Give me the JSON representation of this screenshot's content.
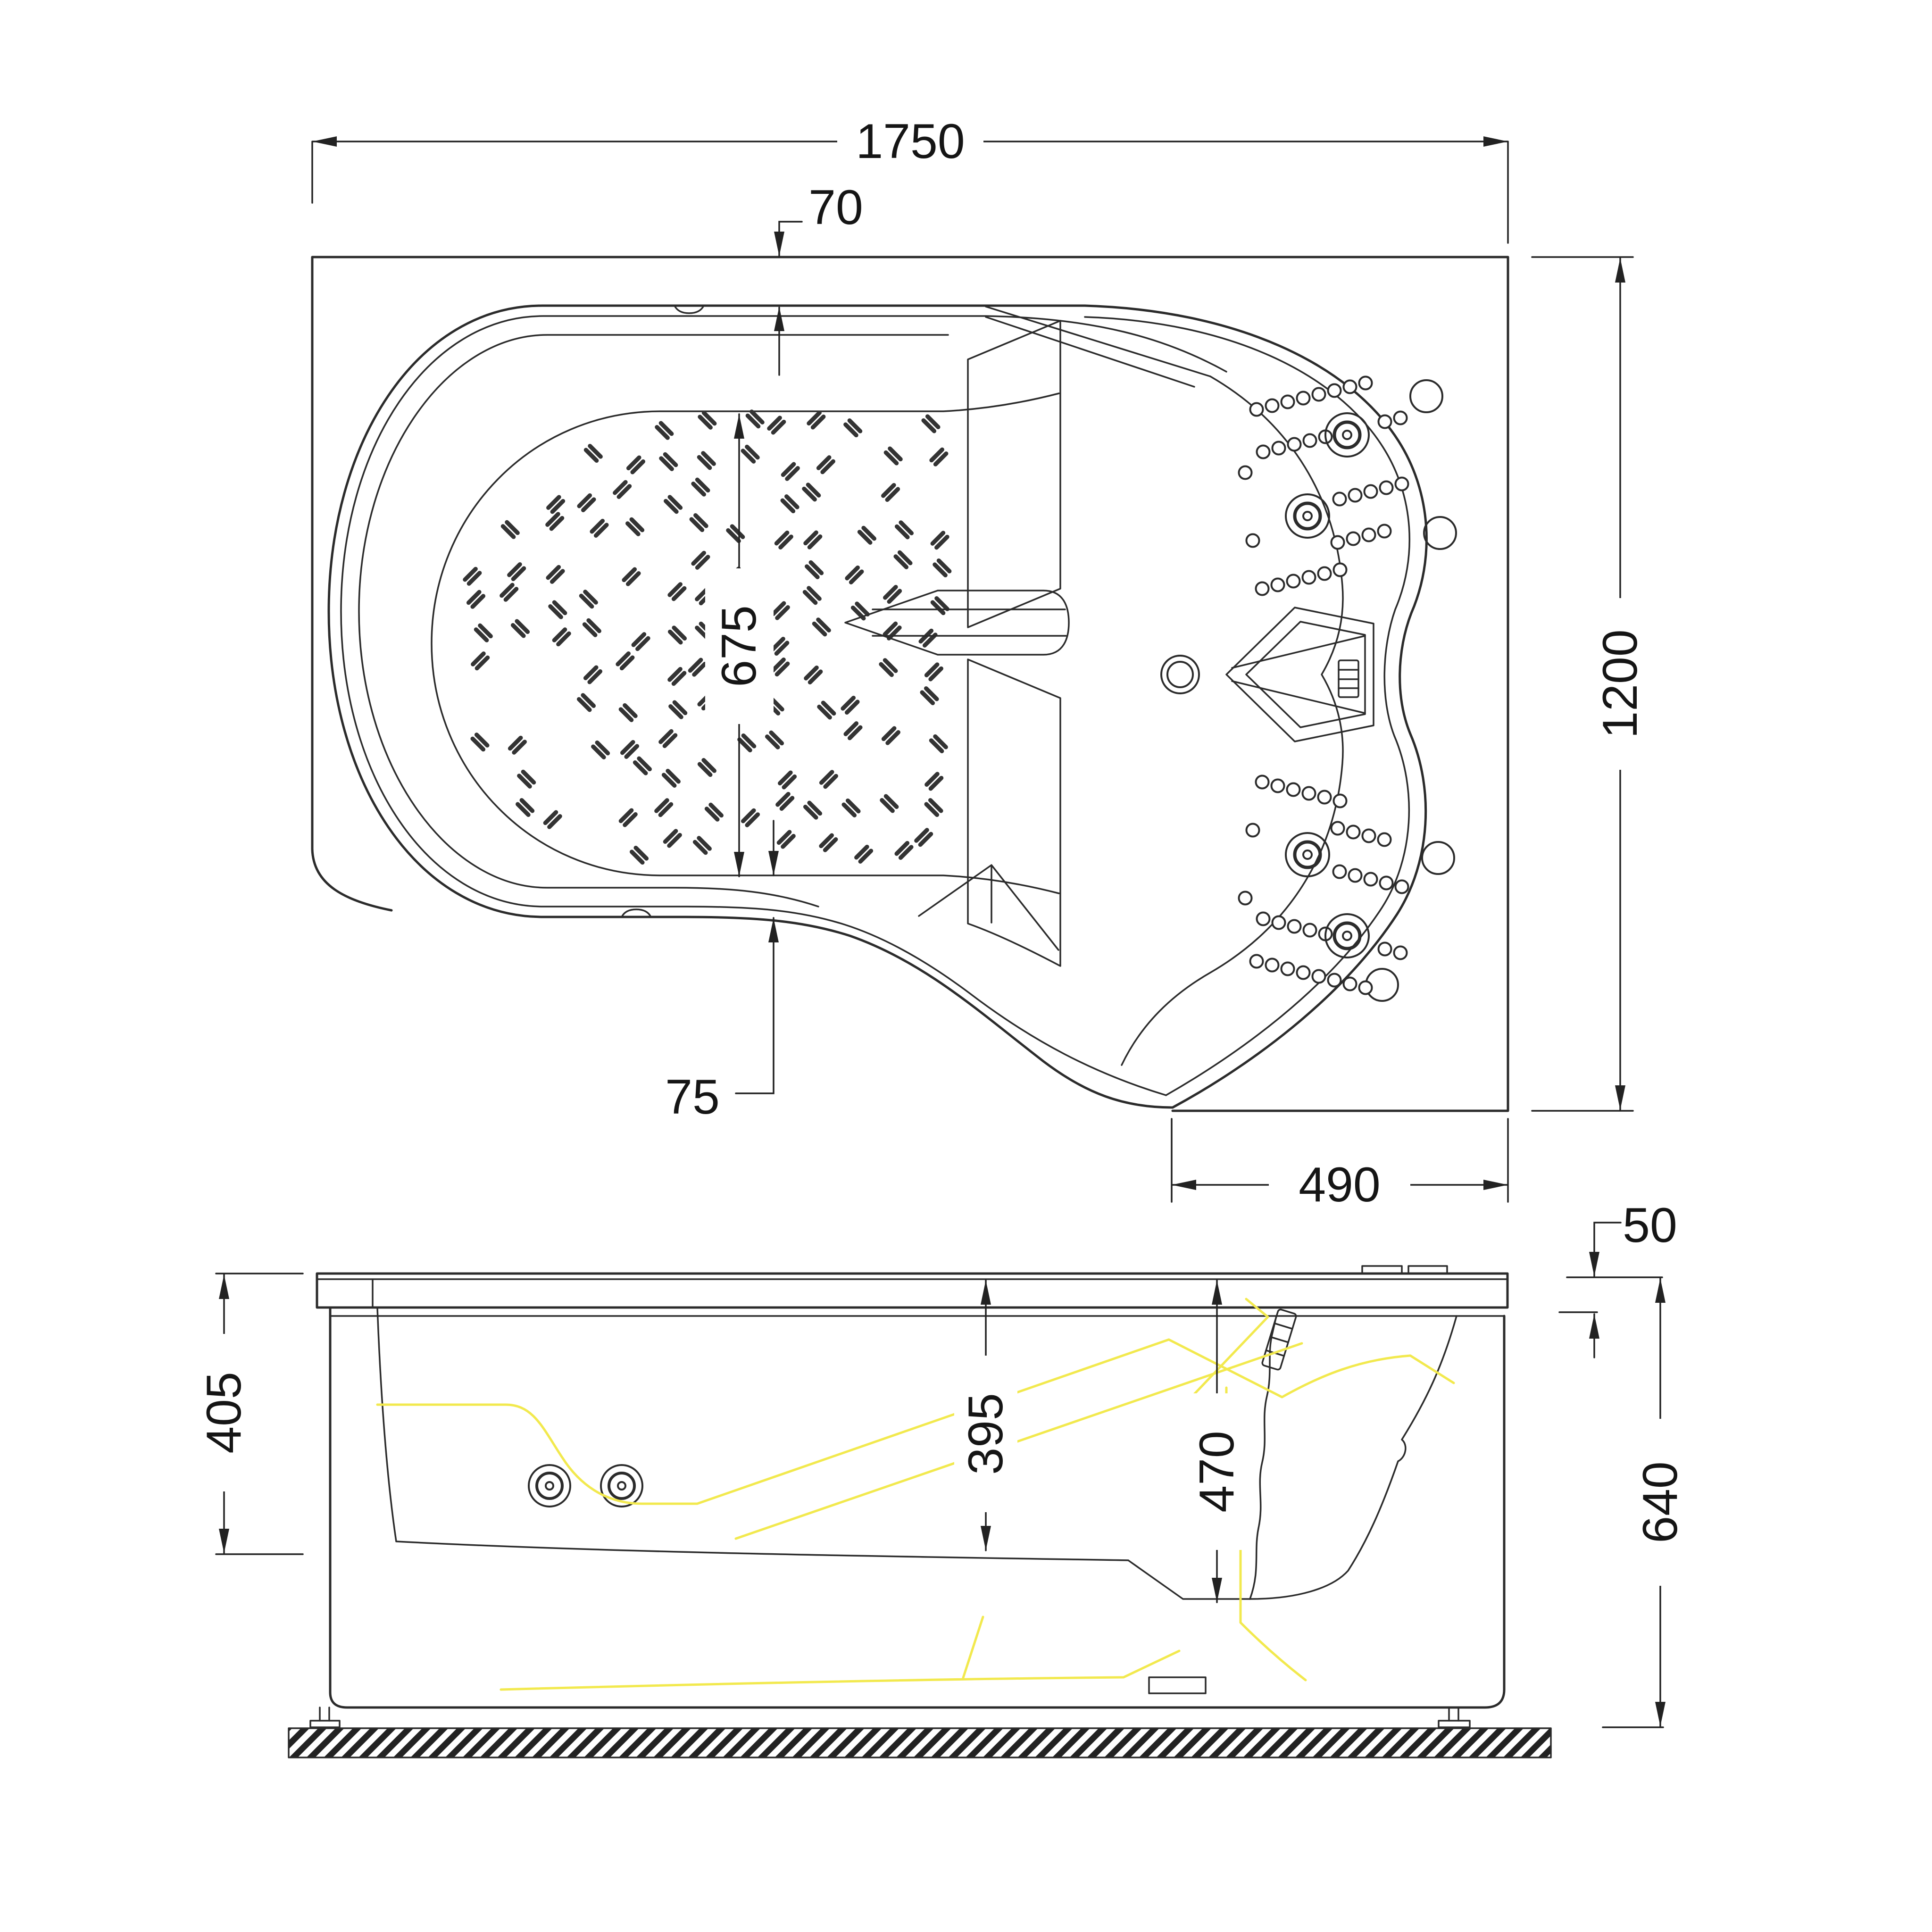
{
  "drawing": {
    "type": "bathtub-technical-drawing",
    "line_color": "#2b2b2b",
    "highlight_color": "#f2e94e",
    "dimensions_mm": {
      "overall_length": "1750",
      "rim_offset_top": "70",
      "basin_width": "675",
      "rim_offset_bottom": "75",
      "seat_section_width": "490",
      "overall_width": "1200",
      "basin_depth_left": "405",
      "seat_depth": "395",
      "basin_depth_right": "470",
      "rim_thickness": "50",
      "overall_height": "640"
    }
  }
}
